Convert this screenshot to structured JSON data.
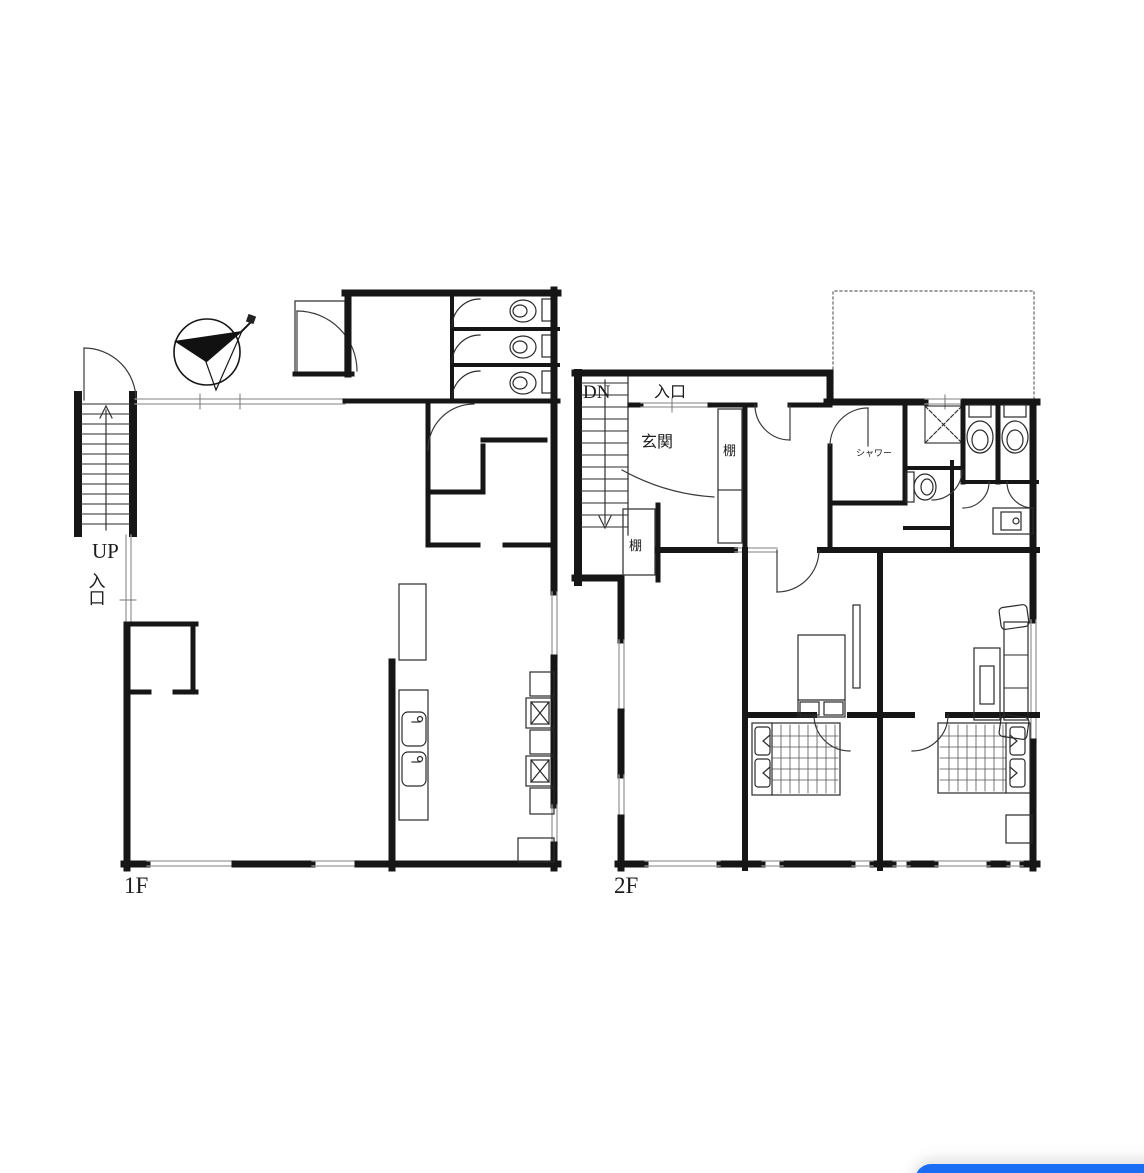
{
  "labels": {
    "floor1": "1F",
    "floor2": "2F",
    "up": "UP",
    "dn": "DN",
    "entrance_1f": "入口",
    "entrance_2f": "入口",
    "genkan": "玄関",
    "shelf_a": "棚",
    "shelf_b": "棚",
    "shower": "シャワー"
  },
  "colors": {
    "wall": "#161616",
    "thin_line": "#3a3a3a",
    "window_line": "#9b9b9b",
    "tread_line": "#555555",
    "button_blue": "#1b6ef3",
    "background": "#ffffff"
  },
  "icons": [
    "north-arrow-compass-icon",
    "stairs-up-icon",
    "stairs-down-icon",
    "toilet-icon",
    "sink-icon",
    "stove-icon",
    "shower-pan-icon",
    "washbasin-icon",
    "bed-icon",
    "sofa-icon",
    "table-icon"
  ]
}
